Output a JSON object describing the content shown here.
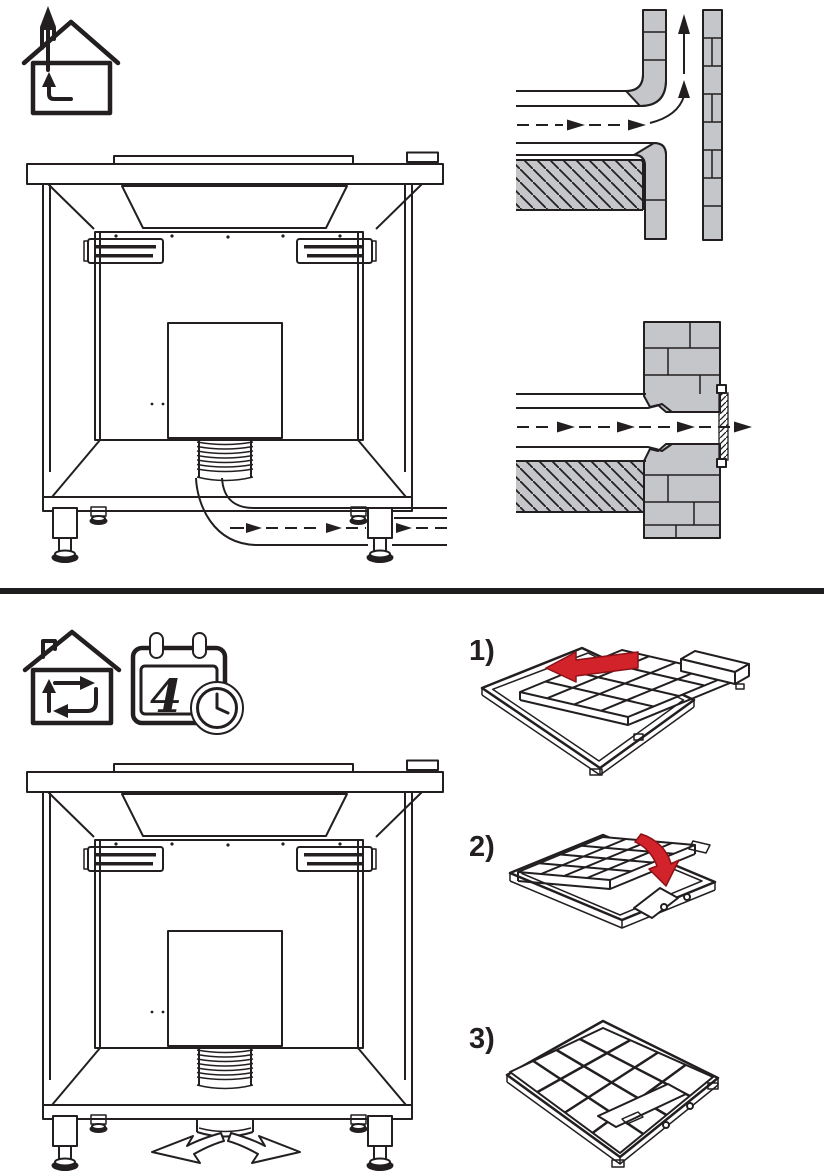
{
  "canvas": {
    "width": 824,
    "height": 1176,
    "background": "#ffffff"
  },
  "colors": {
    "line": "#231f20",
    "wall_gray": "#c5c6ca",
    "accent_red": "#d2232a",
    "red_outline": "#8c1117",
    "divider": "#1d1d1f"
  },
  "sections": [
    {
      "id": "exhaust-air-mode",
      "mode_icon": "house-exhaust-air-icon",
      "illustrations": [
        "cabinet-with-duct-to-outside",
        "duct-bend-into-wall-shaft",
        "duct-straight-through-wall"
      ]
    },
    {
      "id": "recirculation-mode",
      "mode_icon": "house-recirculation-icon",
      "filter_reminder": {
        "interval_number": "4",
        "icons": [
          "calendar-icon",
          "clock-icon"
        ]
      },
      "illustrations": [
        "cabinet-with-room-air-outlet"
      ],
      "steps": [
        {
          "label": "1)"
        },
        {
          "label": "2)"
        },
        {
          "label": "3)"
        }
      ]
    }
  ]
}
